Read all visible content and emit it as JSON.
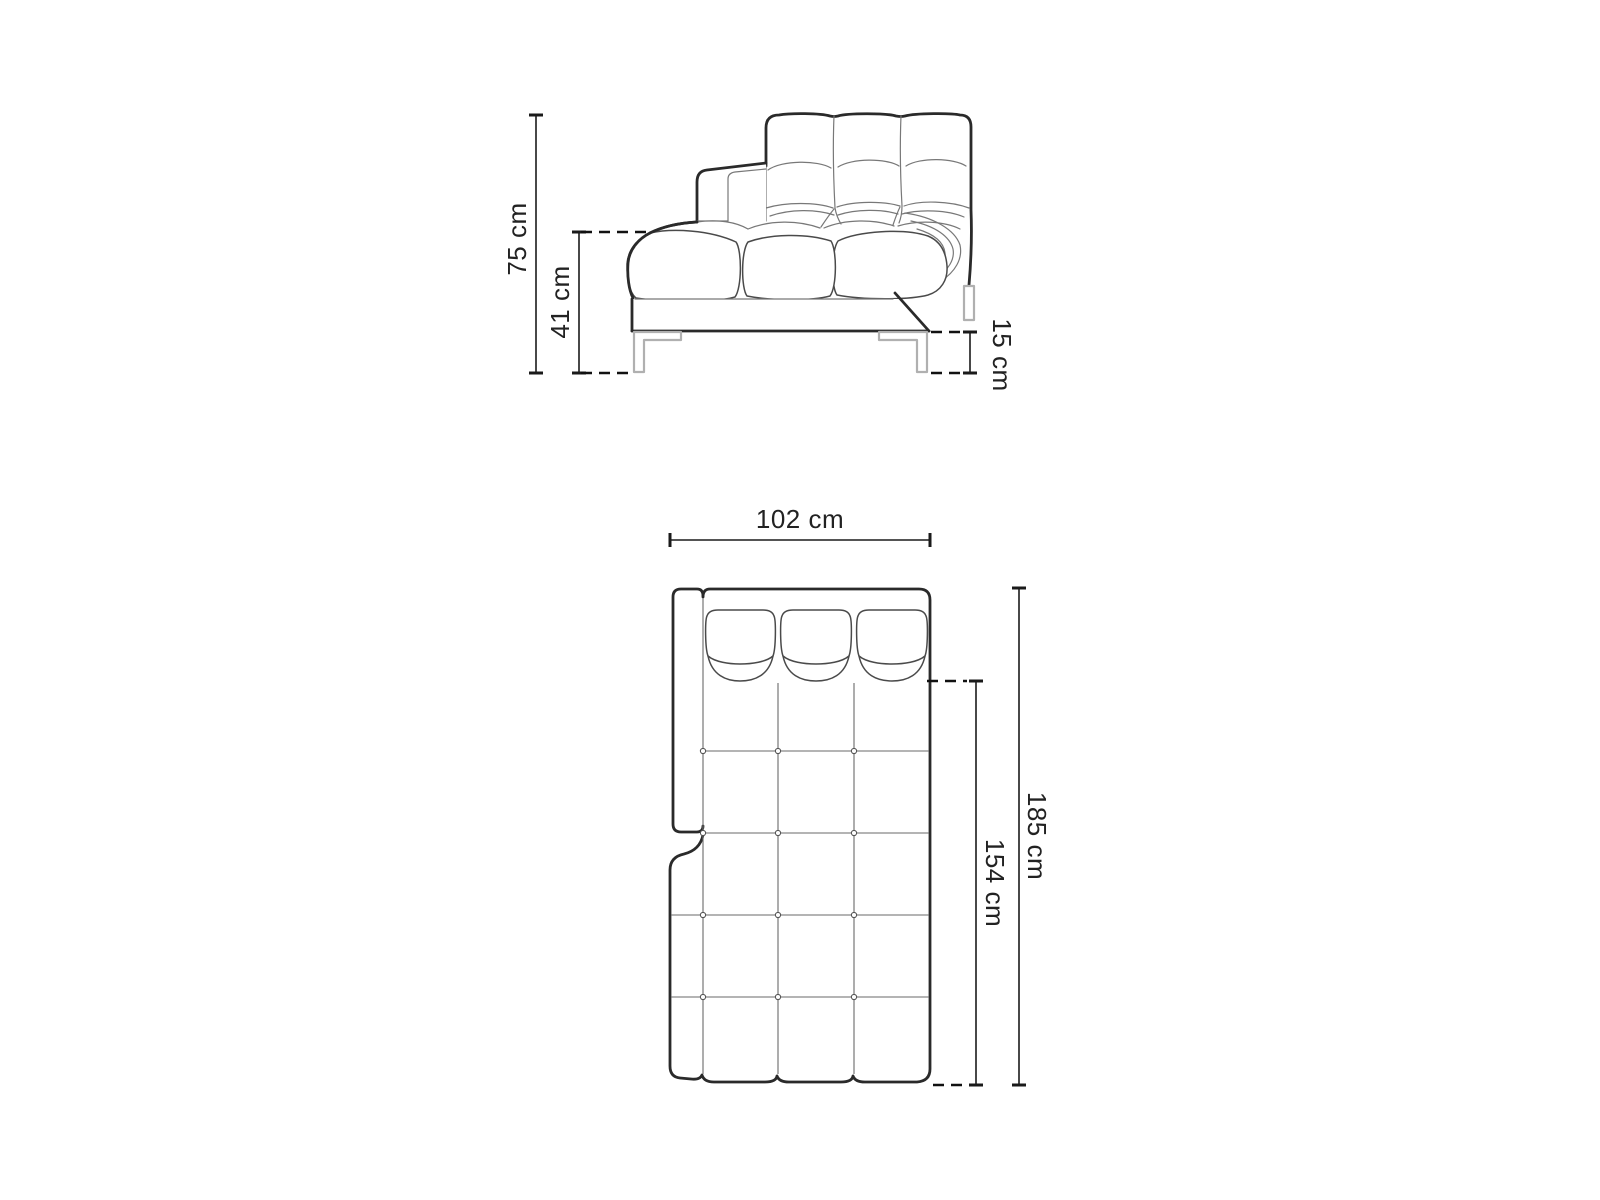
{
  "diagram": {
    "side_view": {
      "overall_height_label": "75 cm",
      "seat_height_label": "41 cm",
      "leg_height_label": "15 cm"
    },
    "plan_view": {
      "width_label": "102 cm",
      "overall_depth_label": "185 cm",
      "seat_depth_label": "154 cm"
    },
    "colors": {
      "background": "#ffffff",
      "outline": "#2a2a2a",
      "seam_line": "#787878",
      "leg": "#b0b0b0",
      "dimension_line": "#1a1a1a",
      "label_text": "#222222"
    }
  }
}
